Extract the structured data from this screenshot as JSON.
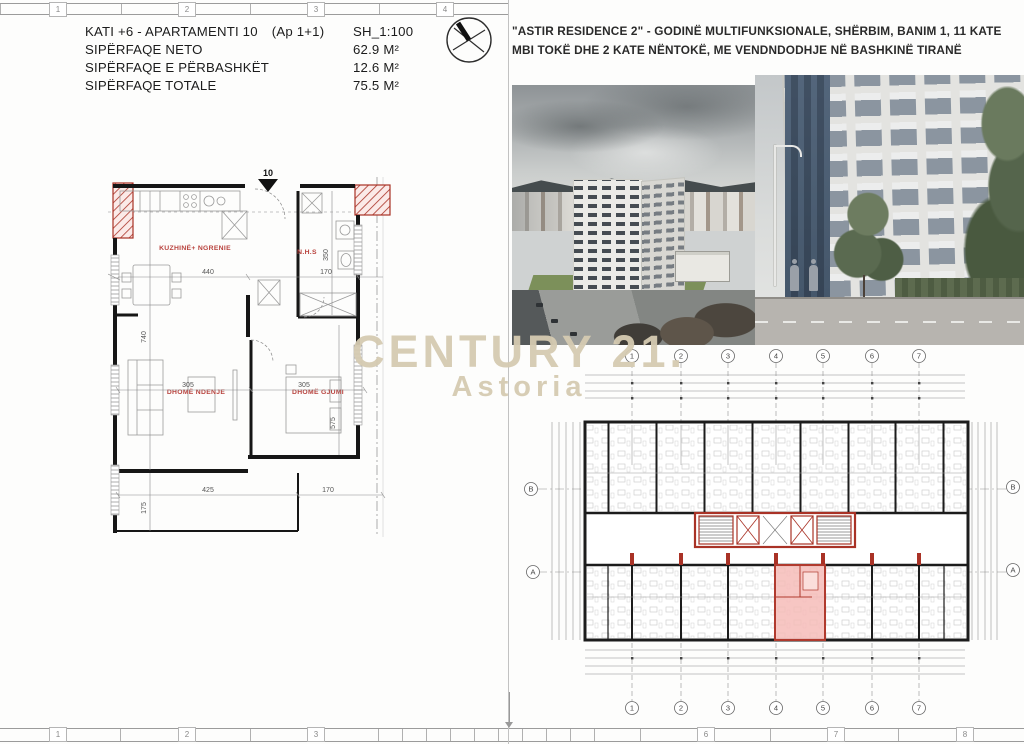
{
  "sheet": {
    "frame": {
      "top_cells": [
        "1",
        "2",
        "3",
        "4"
      ],
      "bottom_cells_left": [
        "1",
        "2",
        "3"
      ],
      "bottom_cells_right": [
        "6",
        "7",
        "8"
      ]
    },
    "info": {
      "title_main": "KATI +6 - APARTAMENTI 10",
      "title_sub": "(Ap 1+1)",
      "scale": "SH_1:100",
      "rows": [
        {
          "label": "SIPËRFAQE NETO",
          "value": "62.9 M²"
        },
        {
          "label": "SIPËRFAQE E PËRBASHKËT",
          "value": "12.6 M²"
        },
        {
          "label": "SIPËRFAQE TOTALE",
          "value": "75.5 M²"
        }
      ]
    },
    "project_title": "\"ASTIR RESIDENCE 2\" - GODINË MULTIFUNKSIONALE, SHËRBIM, BANIM 1, 11 KATE MBI TOKË DHE 2 KATE NËNTOKË, ME VENDNDODHJE NË BASHKINË TIRANË",
    "watermark": {
      "line1": "CENTURY 21.",
      "line2": "Astoria"
    },
    "apartment_plan": {
      "unit_number": "10",
      "rooms": [
        "KUZHINË+ NGRENIE",
        "N.H.S",
        "DHOMË NDENJE",
        "DHOMË GJUMI"
      ],
      "dims": {
        "top_w1": "440",
        "top_w2": "170",
        "left_h": "740",
        "bath_h": "350",
        "living_w": "305",
        "bed_w": "305",
        "bed_h": "575",
        "bot_w1": "425",
        "bot_w2": "170",
        "balc_h": "175"
      }
    },
    "building_plan": {
      "grid_cols": [
        "1",
        "2",
        "3",
        "4",
        "5",
        "6",
        "7"
      ],
      "grid_rows": [
        "B",
        "A"
      ]
    },
    "colors": {
      "plan_red": "#a93226",
      "highlight_pink": "#f6bcb8",
      "label_red": "#b8413c",
      "watermark_beige": "#d5cab1"
    }
  }
}
